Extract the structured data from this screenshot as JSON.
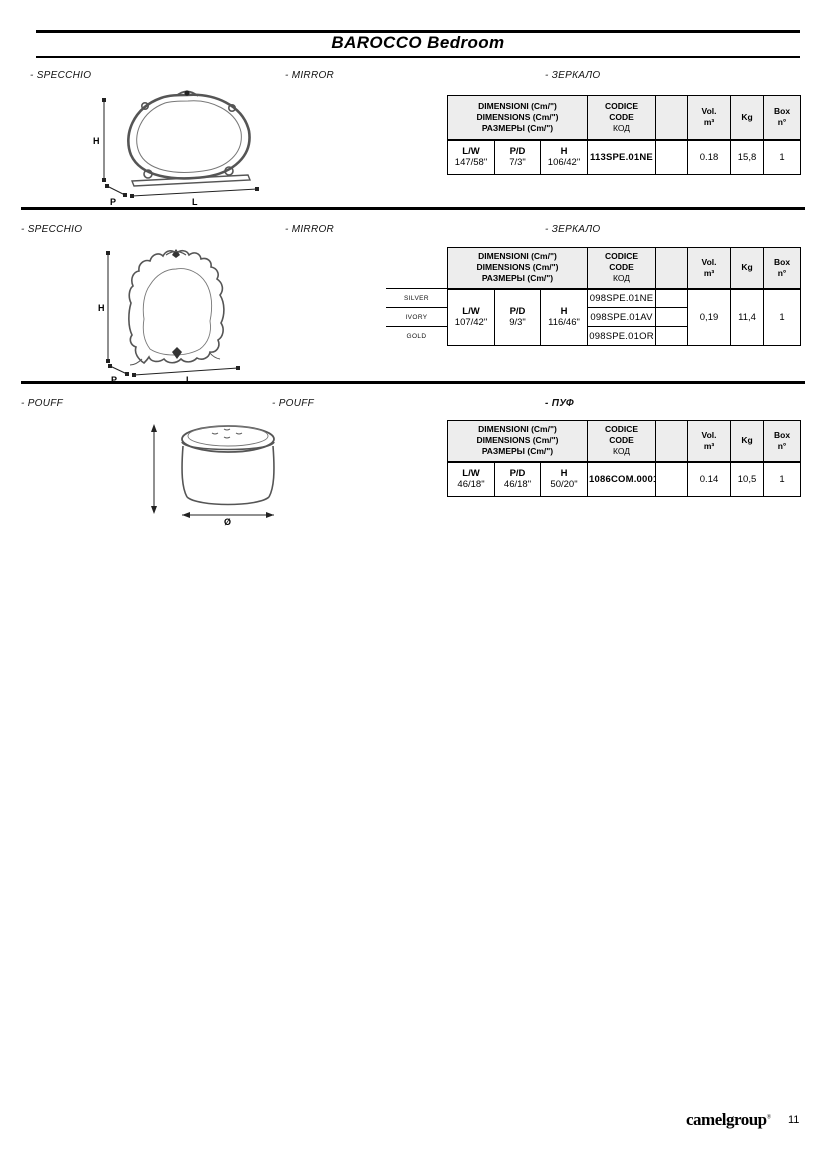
{
  "header": {
    "title": "BAROCCO Bedroom"
  },
  "table_header": {
    "dim1": "DIMENSIONI (Cm/\")",
    "dim2": "DIMENSIONS (Cm/\")",
    "dim3": "РАЗМЕРЫ (Cm/\")",
    "code1": "CODICE",
    "code2": "CODE",
    "code3": "КОД",
    "vol": "Vol.",
    "vol_unit": "m³",
    "kg": "Kg",
    "box": "Box",
    "box_unit": "n°",
    "lw": "L/W",
    "pd": "P/D",
    "h": "H"
  },
  "sections": [
    {
      "label_it": "- SPECCHIO",
      "label_en": "- MIRROR",
      "label_ru": "- ЗЕРКАЛО",
      "drawing": {
        "h": "H",
        "p": "P",
        "l": "L"
      },
      "row": {
        "lw": "147/58\"",
        "pd": "7/3\"",
        "h": "106/42\"",
        "code": "113SPE.01NE",
        "vol": "0.18",
        "kg": "15,8",
        "box": "1"
      }
    },
    {
      "label_it": "- SPECCHIO",
      "label_en": "- MIRROR",
      "label_ru": "- ЗЕРКАЛО",
      "drawing": {
        "h": "H",
        "p": "P",
        "l": "L"
      },
      "finishes": [
        "SILVER",
        "IVORY",
        "GOLD"
      ],
      "codes": [
        "098SPE.01NE",
        "098SPE.01AV",
        "098SPE.01OR"
      ],
      "row": {
        "lw": "107/42\"",
        "pd": "9/3\"",
        "h": "116/46\"",
        "vol": "0,19",
        "kg": "11,4",
        "box": "1"
      }
    },
    {
      "label_it": "- POUFF",
      "label_en": "- POUFF",
      "label_ru": "- ПУФ",
      "drawing": {
        "diameter": "Ø"
      },
      "row": {
        "lw": "46/18\"",
        "pd": "46/18\"",
        "h": "50/20\"",
        "code": "1086COM.00011",
        "vol": "0.14",
        "kg": "10,5",
        "box": "1"
      }
    }
  ],
  "footer": {
    "logo": "camelgroup",
    "logo_mark": "®",
    "page_number": "11"
  }
}
